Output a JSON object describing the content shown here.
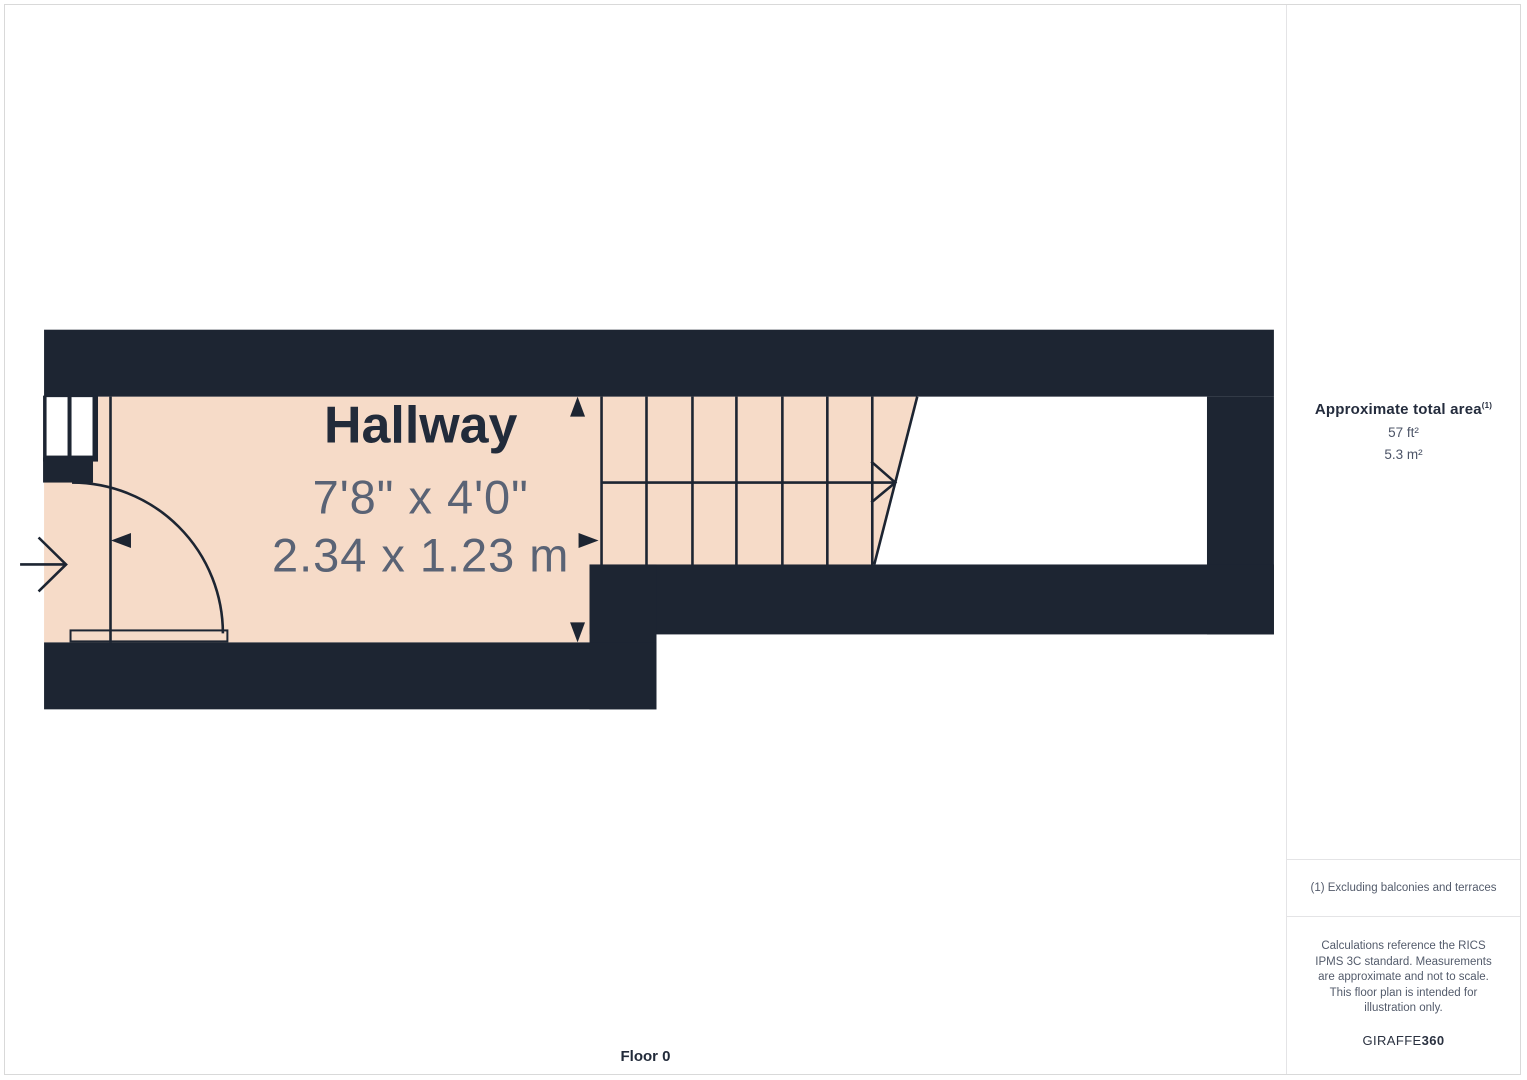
{
  "floor_plan": {
    "room": {
      "name": "Hallway",
      "dimensions_imperial": "7'8\" x 4'0\"",
      "dimensions_metric": "2.34 x 1.23 m"
    },
    "floor_label": "Floor 0"
  },
  "sidebar": {
    "area": {
      "title": "Approximate total area",
      "title_superscript": "(1)",
      "imperial": "57 ft²",
      "metric": "5.3 m²"
    },
    "footnote": "(1) Excluding balconies and terraces",
    "disclaimer": "Calculations reference the RICS IPMS 3C standard. Measurements are approximate and not to scale. This floor plan is intended for illustration only.",
    "logo": {
      "prefix": "GIRAFFE",
      "suffix": "360"
    }
  },
  "colors": {
    "wall": "#1d2532",
    "room_fill": "#f6dbc8",
    "room_label": "#222b3a",
    "dimension_text": "#5a6375",
    "frame_border": "#d9d9d9",
    "divider": "#e4e4e6",
    "sidebar_title": "#242c3d",
    "sidebar_value": "#4c5467",
    "sidebar_note": "#535b6b",
    "logo": "#2a3140"
  }
}
